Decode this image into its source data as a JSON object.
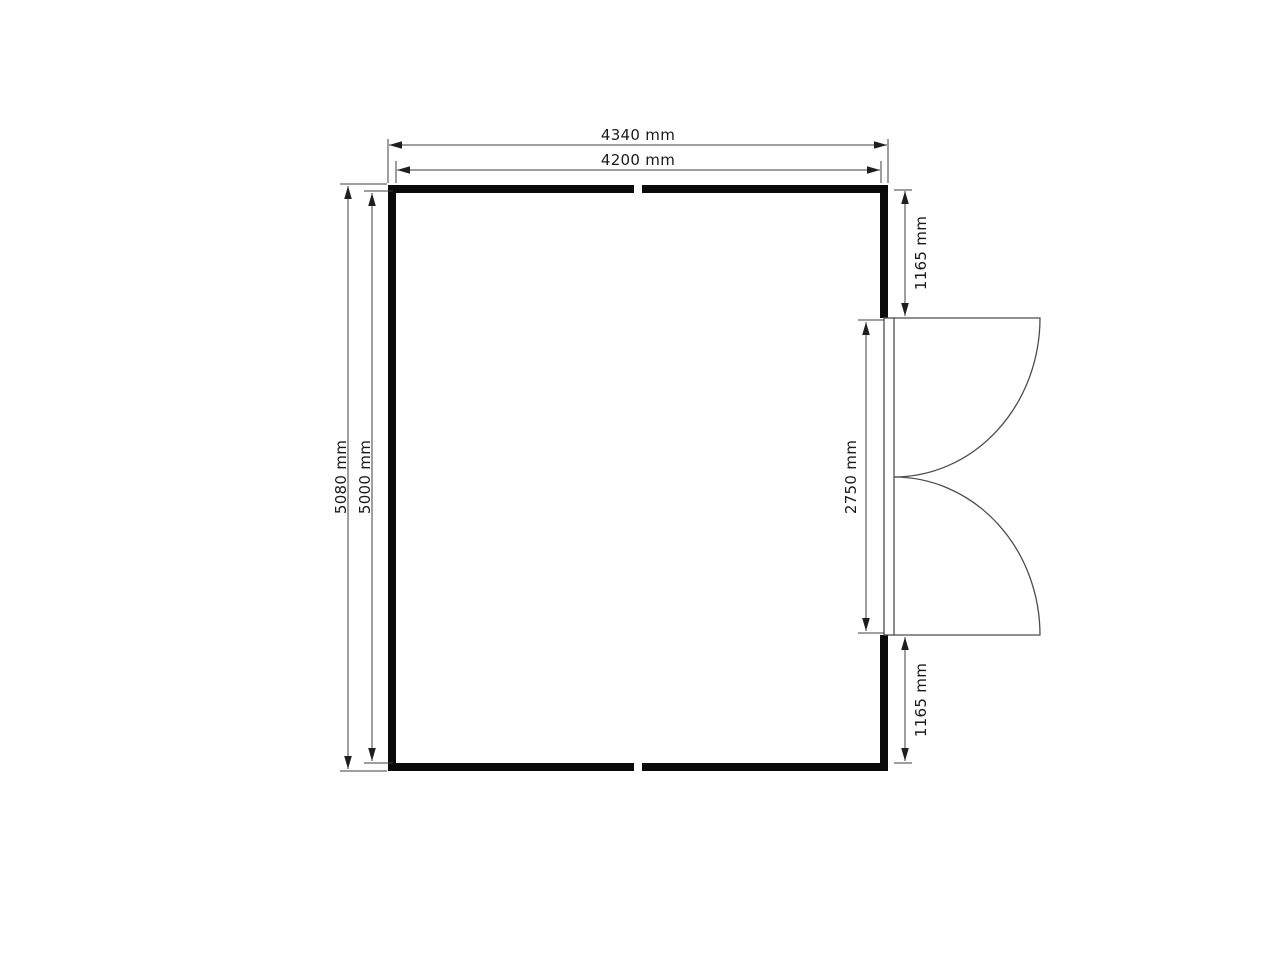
{
  "floor_plan": {
    "description": "room-floor-plan-with-double-swing-door",
    "dimensions": {
      "outer_width_label": "4340 mm",
      "inner_width_label": "4200 mm",
      "outer_height_label": "5080 mm",
      "inner_height_label": "5000 mm",
      "door_offset_top_label": "1165 mm",
      "door_opening_label": "2750 mm",
      "door_offset_bottom_label": "1165 mm"
    },
    "colors": {
      "background": "#ffffff",
      "wall": "#0a0a0a",
      "dimension_line": "#3f3f3f",
      "door_line": "#4d4d4d",
      "label_text": "#1a1a1a"
    }
  }
}
